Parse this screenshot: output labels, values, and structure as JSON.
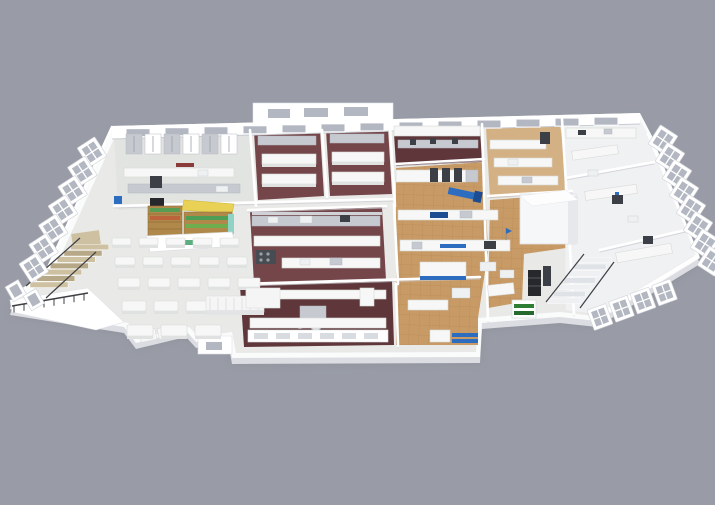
{
  "meta": {
    "title": "3D isometric cutaway rendering of a facility floor plan",
    "description": "Architectural 3D render on a gray background: a single-storey facility seen from above at an angle. Left wing holds a cafeteria with rows of white tables and a small yellow-canopied kiosk shop; the center holds kitchens with maroon floors, stainless galley lines and a front serving counter; the right-center is a wood-tile production hall with white machinery with blue accents, a white walk-in cold room and a staircase; the far right wing holds white laboratory rooms. The perimeter is lined with tilted white window bays, with a balcony walkway and tan stairs on the far left."
  },
  "canvas": {
    "width": 715,
    "height": 505,
    "background_color": "#999ca6"
  },
  "palette": {
    "slab_top": "#fafbfb",
    "slab_side": "#dcdde2",
    "ground_shadow": "#84868f",
    "wall_white": "#ffffff",
    "wall_shadow": "#c9cbd2",
    "floor_light": "#e9eae7",
    "floor_kitchen": "#e2e4e2",
    "floor_labs": "#eff1f3",
    "floor_maroon": "#74464a",
    "floor_maroon_dark": "#5f373b",
    "floor_wood": "#c79a66",
    "floor_wood_light": "#d4b184",
    "wood_grid": "#ab7c48",
    "stainless": "#c6cad0",
    "equipment_dark": "#3c4046",
    "equipment_black": "#26282c",
    "accent_blue": "#2d6dbf",
    "accent_blue_dark": "#1c4c92",
    "accent_red": "#8c3b3b",
    "glass": "#b3b7c1",
    "kiosk_yellow": "#e8d155",
    "kiosk_wood": "#b08849",
    "kiosk_green": "#4f9e55",
    "logo_green": "#3fa06a",
    "stair_tan": "#cec1a2",
    "stair_tan_dark": "#b7a987",
    "rail_dark": "#3f4045",
    "plant_green": "#2e7d35",
    "plant_green_dark": "#256b2d"
  },
  "zones": [
    {
      "id": "cafeteria",
      "label": "cafeteria-seating-area"
    },
    {
      "id": "kiosk",
      "label": "kiosk-shop"
    },
    {
      "id": "kitchen-top-left",
      "label": "prep-kitchen"
    },
    {
      "id": "maroon-rooms",
      "label": "cooking-suites-maroon-floor"
    },
    {
      "id": "galley",
      "label": "galley-kitchen-line"
    },
    {
      "id": "front-kitchen",
      "label": "front-kitchen-serving-line"
    },
    {
      "id": "production",
      "label": "wood-floor-production-hall"
    },
    {
      "id": "cold-room",
      "label": "walk-in-cold-room"
    },
    {
      "id": "labs",
      "label": "laboratory-wing"
    },
    {
      "id": "balcony",
      "label": "balcony-walkway-and-stairs"
    }
  ],
  "counts": {
    "back_wall_windows": 13,
    "left_window_bays": 7,
    "right_window_bays": 8,
    "front_right_window_bays": 4,
    "cafeteria_table_rows": 5,
    "stair_steps": 7,
    "balcony_rail_posts": 8,
    "cabinet_slots": 7,
    "serving_tray_slots": 6,
    "fridge_units": 6
  }
}
